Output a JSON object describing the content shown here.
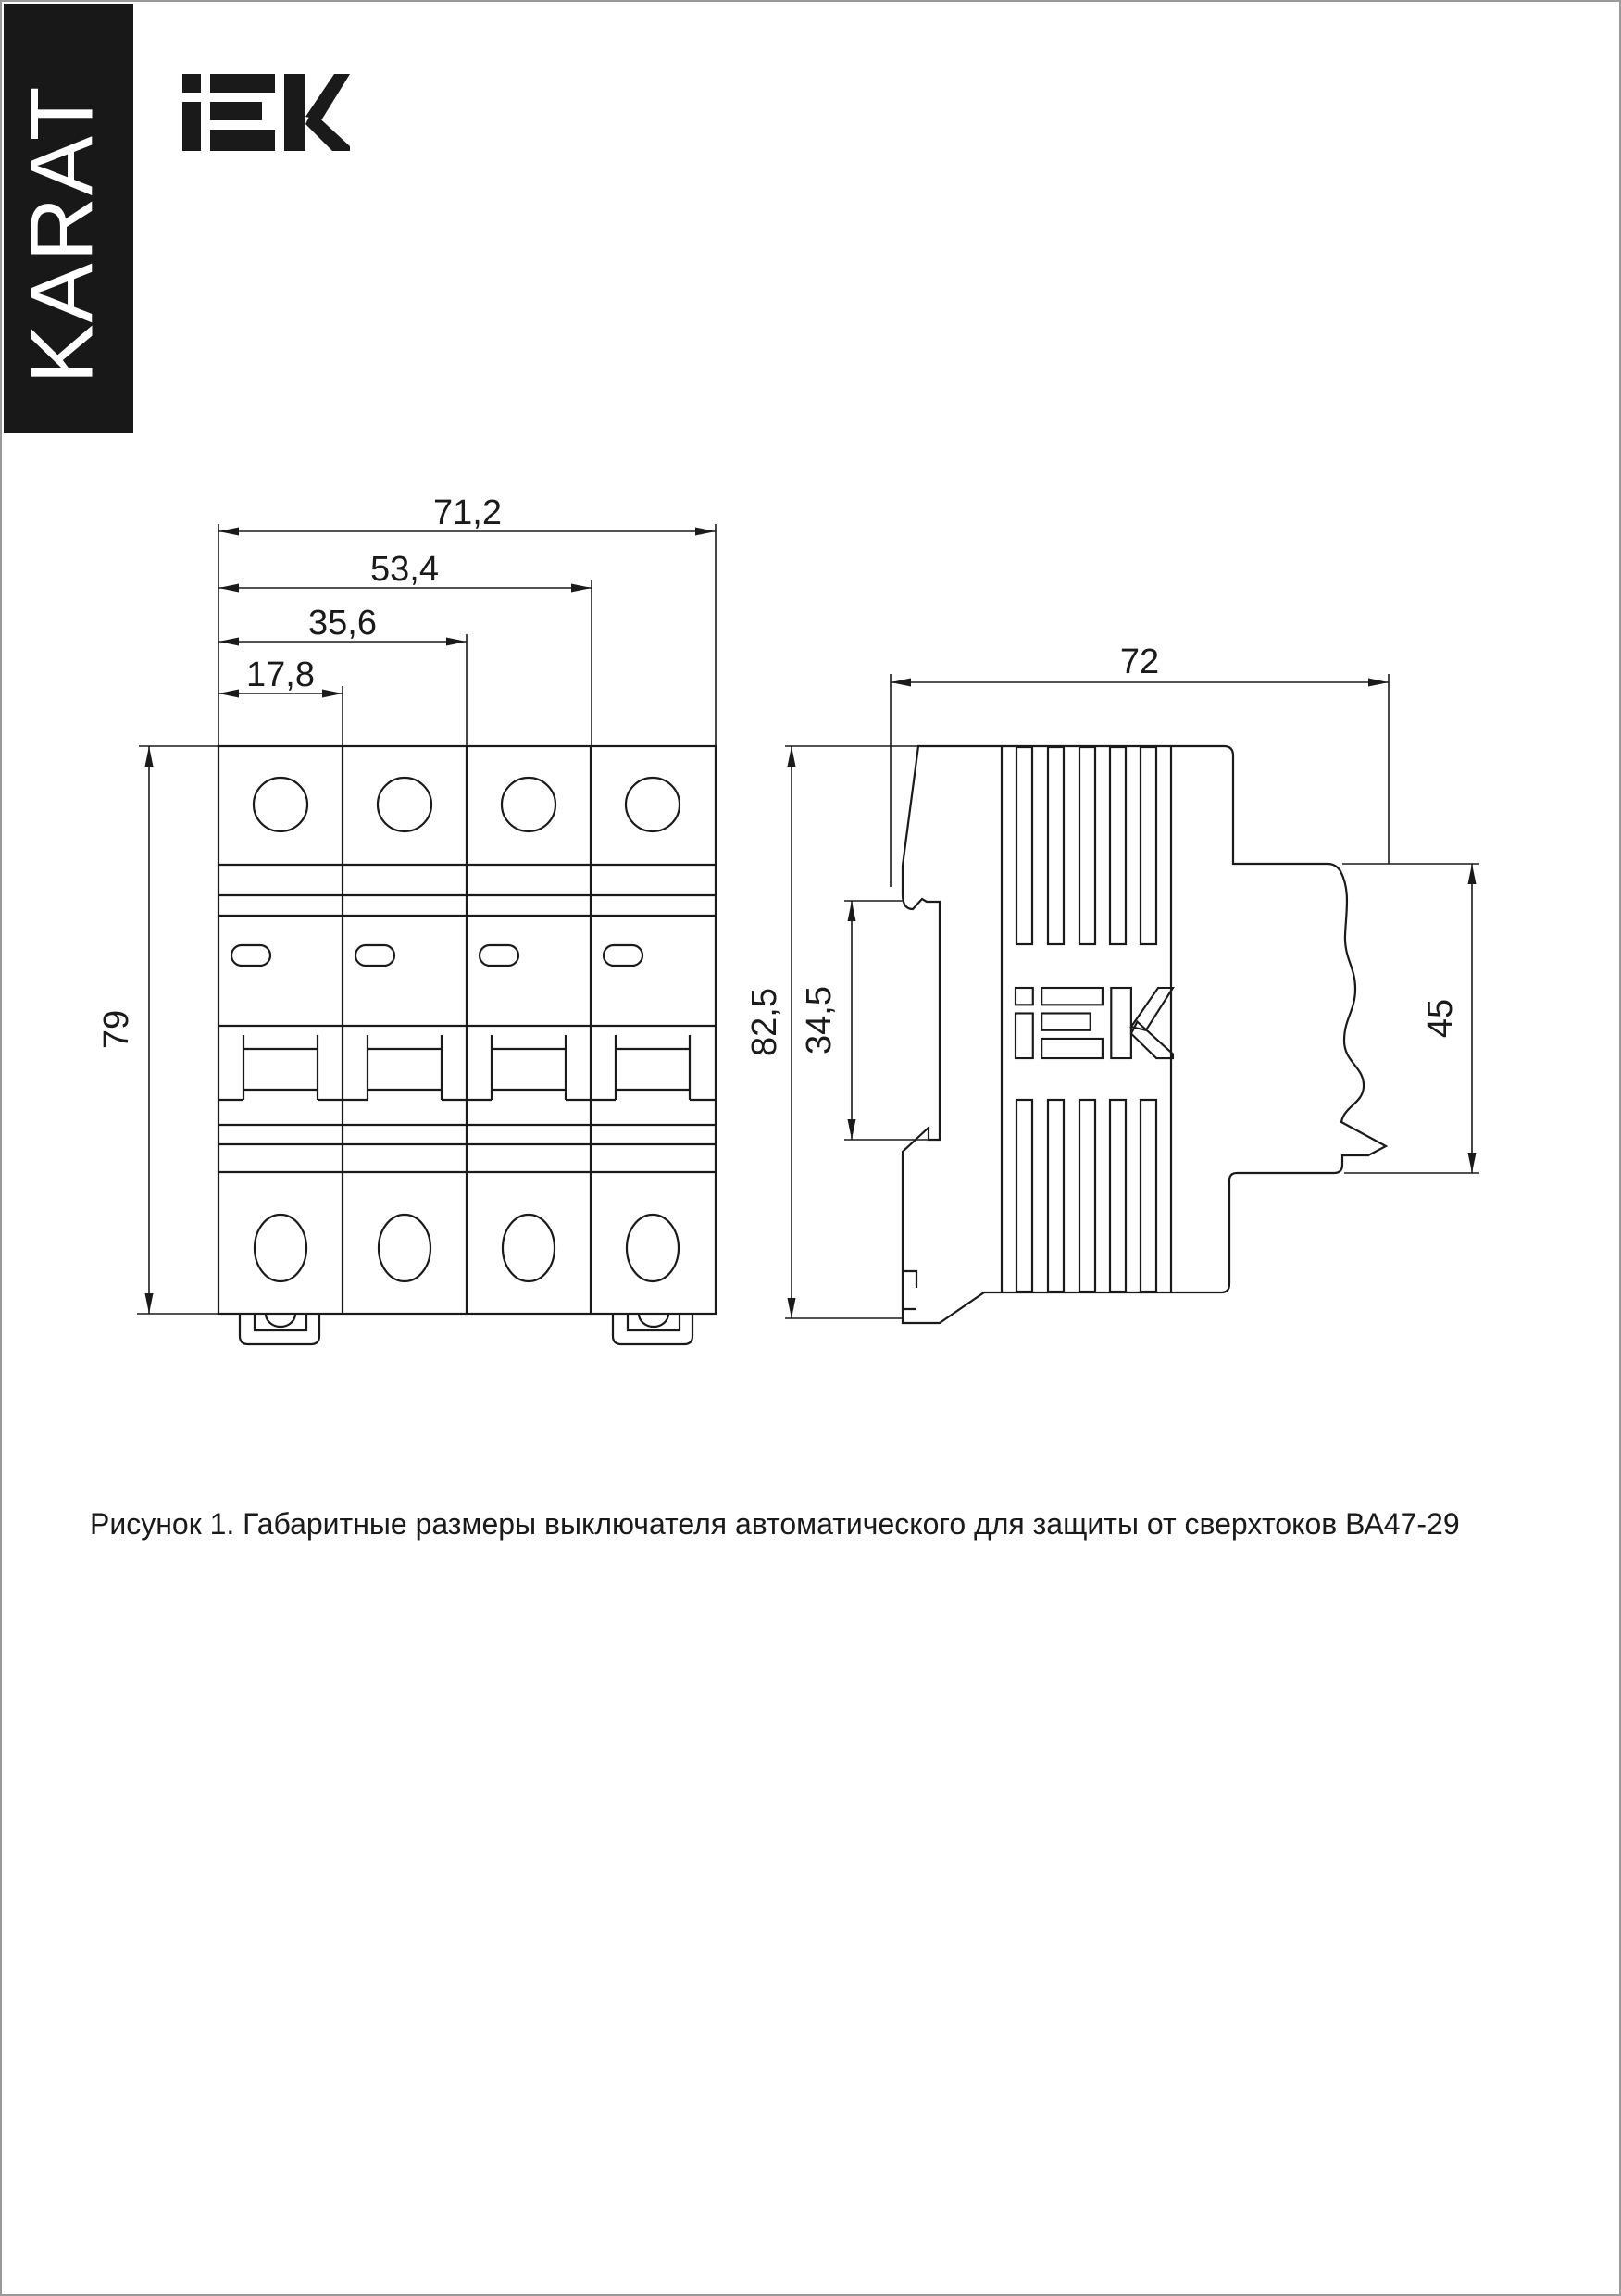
{
  "banner": {
    "text": "KARAT"
  },
  "brand": {
    "logo_text": "IEK"
  },
  "drawing": {
    "front_view": {
      "dim_width_total": "71,2",
      "dim_width_3poles": "53,4",
      "dim_width_2poles": "35,6",
      "dim_width_1pole": "17,8",
      "dim_height": "79"
    },
    "side_view": {
      "dim_depth": "72",
      "dim_height_total": "82,5",
      "dim_din_window": "34,5",
      "dim_front_height": "45"
    }
  },
  "caption": "Рисунок 1. Габаритные размеры выключателя автоматического для защиты от сверхтоков ВА47-29",
  "colors": {
    "line": "#1a1a1a",
    "banner_bg": "#181818",
    "banner_fg": "#ffffff"
  }
}
